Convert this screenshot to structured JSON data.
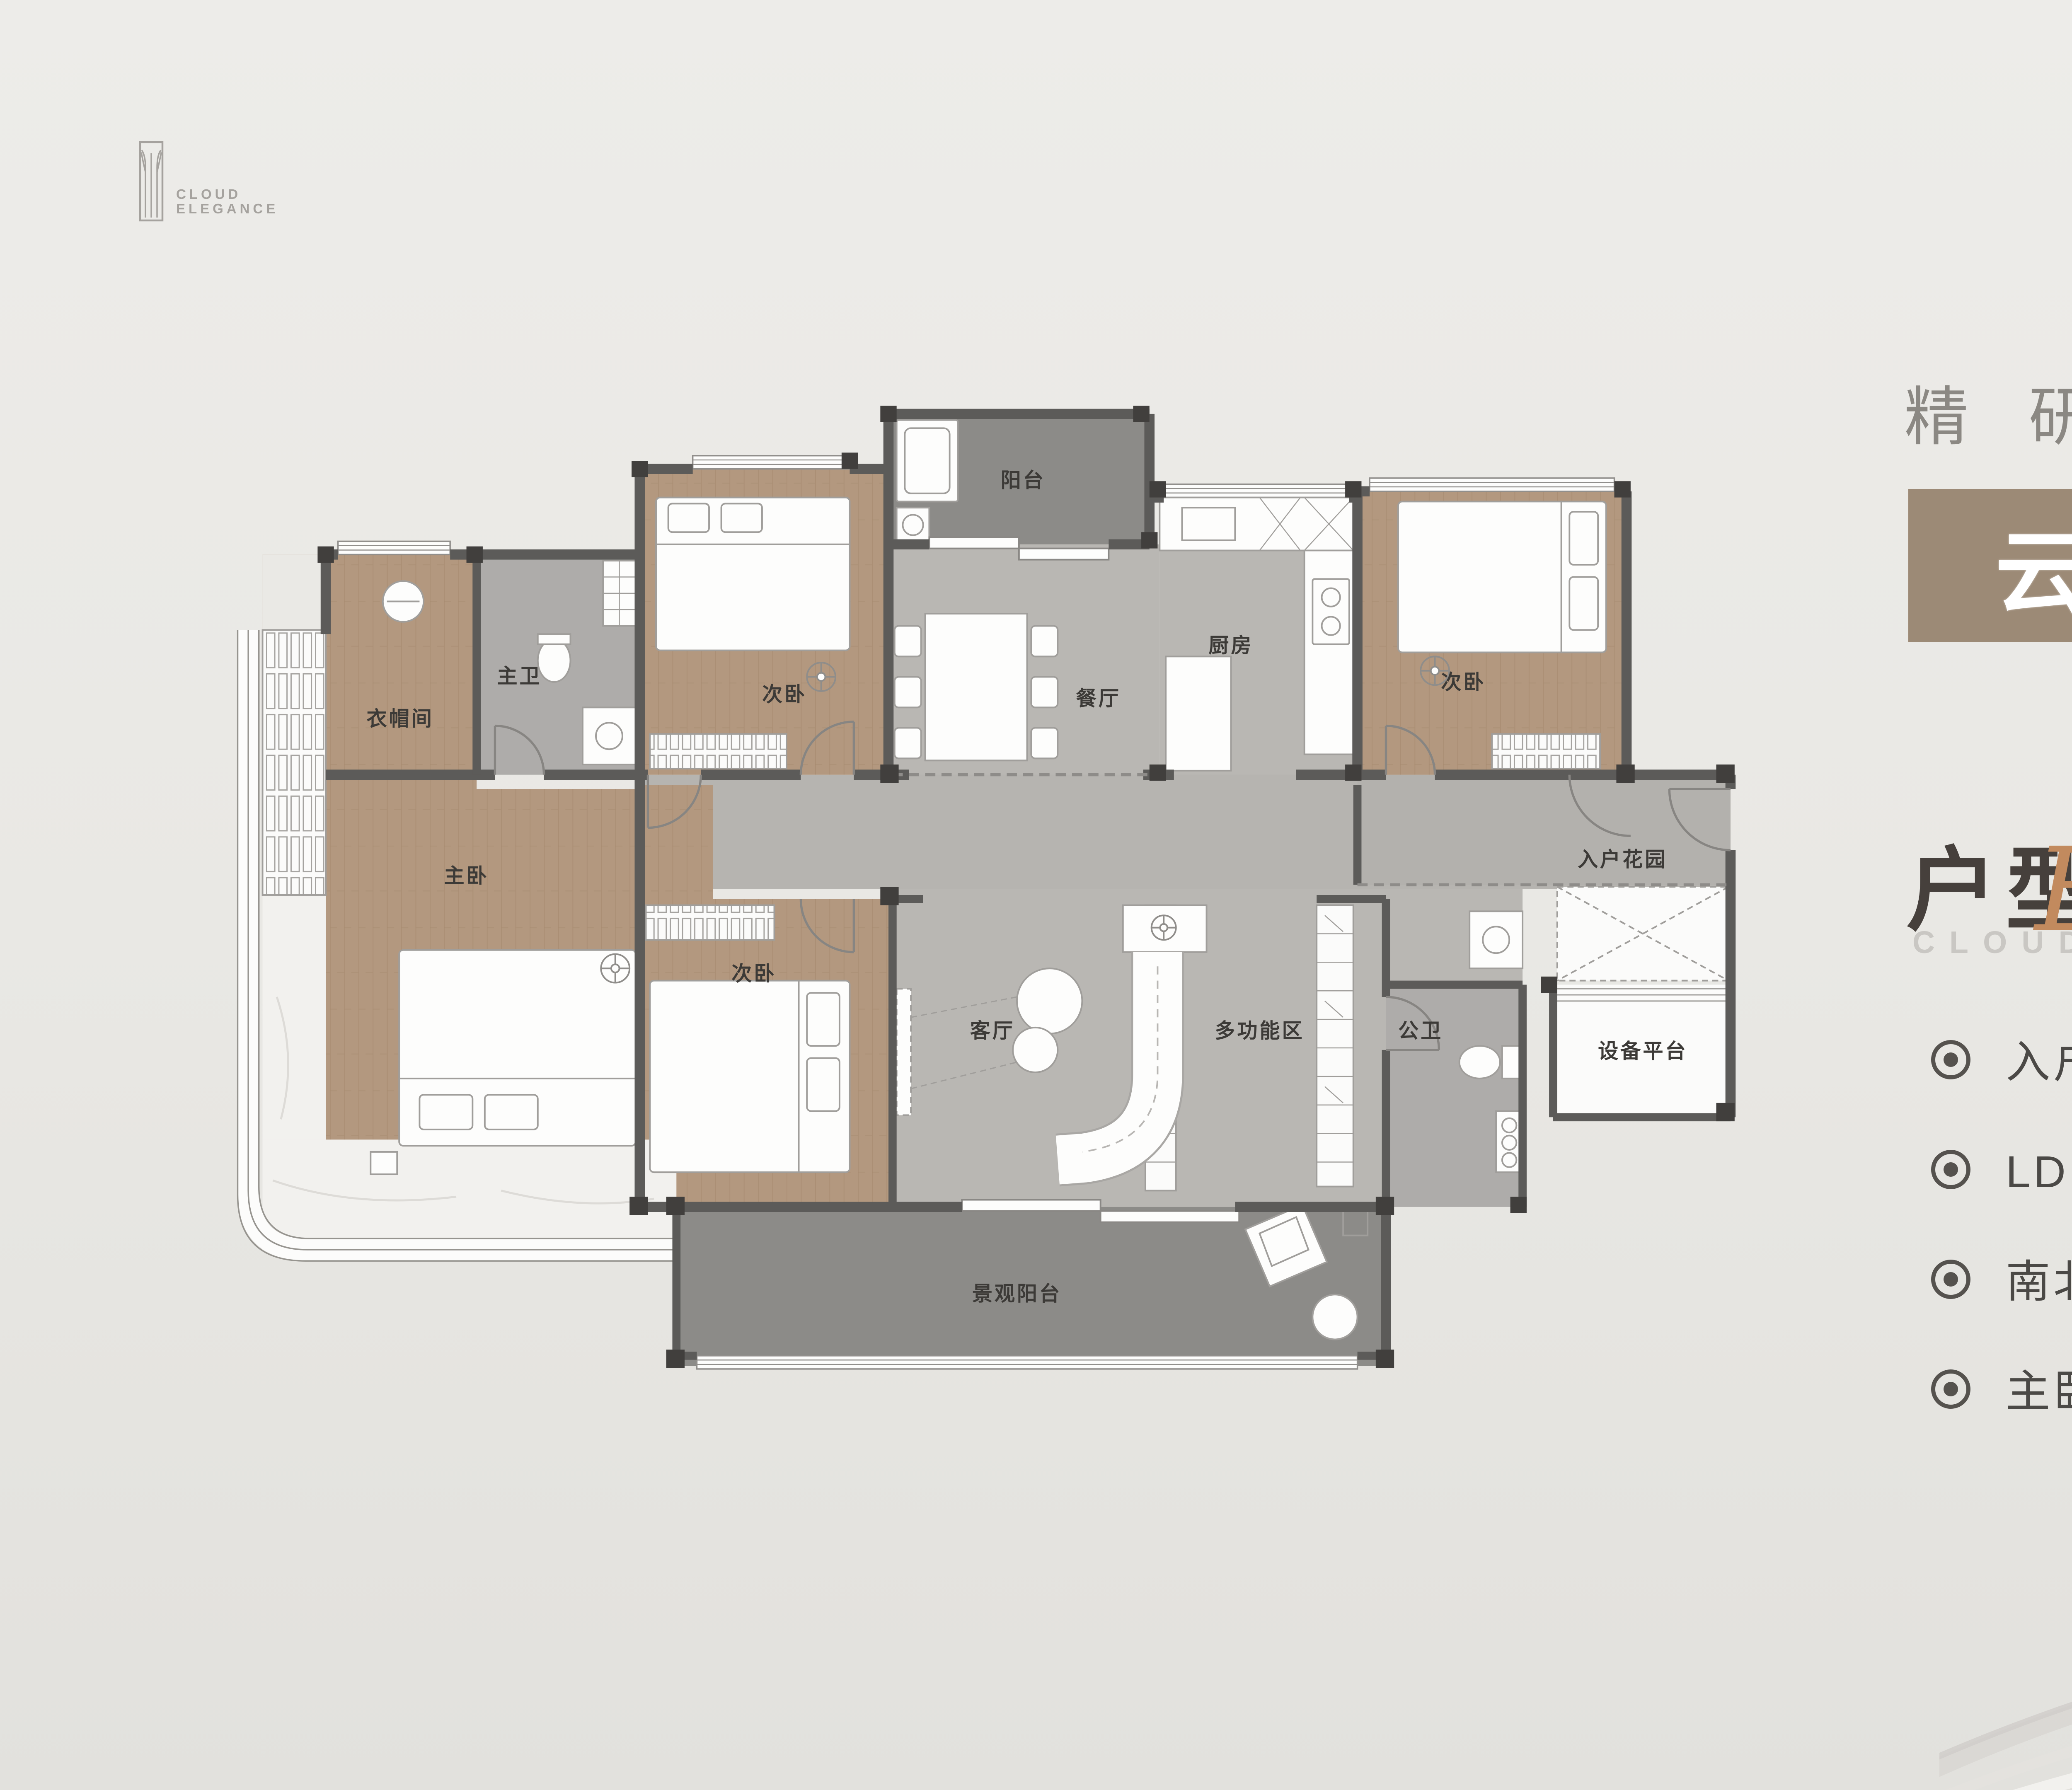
{
  "logo": {
    "line1": "CLOUD",
    "line2": "ELEGANCE"
  },
  "slogan": "精研空间人居美学",
  "badge": {
    "name": "云领",
    "type": "四室二厅二卫",
    "area_prefix": "建筑面积约",
    "area_value": "123",
    "area_unit": "m",
    "area_sup": "2",
    "bg_color": "#9c8a76"
  },
  "section": {
    "title": "户型赏析",
    "subtitle_caps": "CLOUD",
    "subtitle_script": "Elegance",
    "script_color": "#c28a5e"
  },
  "bullets": [
    {
      "text": "入户花园设计，私藏生活小确幸"
    },
    {
      "text": "LDKB一体化大方厅，迭新空间想象"
    },
    {
      "text": "南北对流双阳台，享清风阳光"
    },
    {
      "text": "主卧步入式衣帽间，270°全屏飘窗"
    }
  ],
  "floorplan": {
    "rooms": {
      "balcony_north": "阳台",
      "bedroom_nw": "次卧",
      "master_bath": "主卫",
      "cloakroom": "衣帽间",
      "dining": "餐厅",
      "kitchen": "厨房",
      "bedroom_ne": "次卧",
      "entry_garden": "入户花园",
      "master_bedroom": "主卧",
      "bedroom_sw": "次卧",
      "living": "客厅",
      "multi_zone": "多功能区",
      "guest_bath": "公卫",
      "equipment": "设备平台",
      "balcony_south": "景观阳台"
    },
    "wall_color": "#5c5b59",
    "wood_color": "#b3987f",
    "marble_color": "#b9b7b3",
    "balcony_color": "#8c8b88"
  },
  "watermark": {
    "text": "搜狐号@搜狐焦点防城港站"
  }
}
